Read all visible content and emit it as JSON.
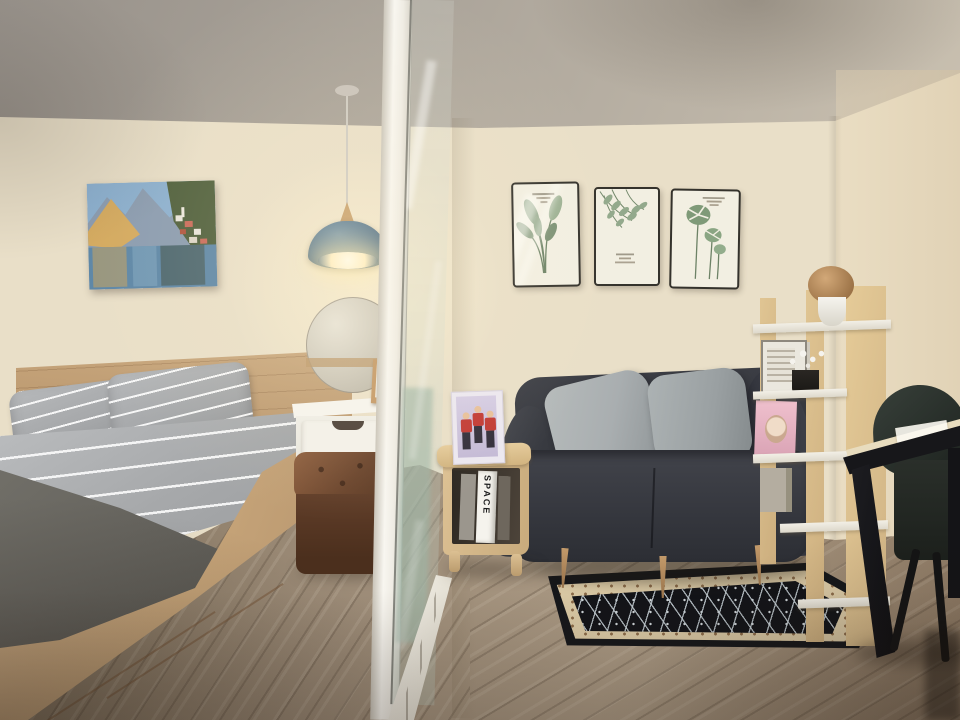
{
  "meta": {
    "kind": "interior-photograph",
    "description": "Small studio room: bedroom with bed, vanity and pendant lamp on the left behind a glass partition; living area with dark loveseat, botanical prints, corner shelf, side table, rug, desk and chair on the right",
    "width_px": 960,
    "height_px": 720
  },
  "texts": {
    "book_spine": "SPACE"
  },
  "palette": {
    "wall": "#e9dfc8",
    "ceiling_dark": "#97918a",
    "ceiling_light": "#c9c0b0",
    "floor": "#9c8b77",
    "bed_wood": "#cbaa80",
    "sheet": "#aaacae",
    "blanket": "#66645e",
    "sofa": "#36383e",
    "cushion": "#a9aeb0",
    "ottoman": "#6b452d",
    "vanity_white": "#f4f2ec",
    "lamp_blue": "#54738a",
    "lamp_wood": "#c8a06c",
    "glow": "#ffefc4",
    "glass": "#9db5a6",
    "rug_black": "#16171a",
    "rug_border": "#d9c8a4",
    "rug_accent": "#8a6a48",
    "wood_light": "#dcc093",
    "chair_green": "#2a312c",
    "desk_black": "#17171a",
    "desk_top": "#e8dcbe",
    "print_frame": "#34322c",
    "print_paper": "#f2efe2",
    "leaf_green": "#83987b"
  },
  "objects": {
    "bedroom": [
      "mountain-lake-painting",
      "blue-pendant-lamp",
      "round-mirror",
      "white-vanity-with-drawer",
      "small-wood-photo-frame",
      "brown-leather-ottoman",
      "bed-with-striped-gray-bedding",
      "two-striped-pillows",
      "dark-gray-blanket",
      "wood-bed-base-with-drawers"
    ],
    "divider": [
      "white-framed-glass-partition",
      "floor-sliding-track"
    ],
    "living_area": [
      "botanical-print-1",
      "botanical-print-2",
      "botanical-print-3",
      "dark-gray-loveseat",
      "two-gray-cushions",
      "corner-shelf-unit",
      "dried-flower-ball-in-white-pot",
      "white-flowers-in-black-pot",
      "framed-pictures-stack",
      "pink-magazine",
      "wood-side-table",
      "red-outfit-photo-frame",
      "space-book",
      "black-oriental-rug",
      "black-frame-desk",
      "dark-green-chair"
    ],
    "floor": "wood-laminate-planks"
  }
}
